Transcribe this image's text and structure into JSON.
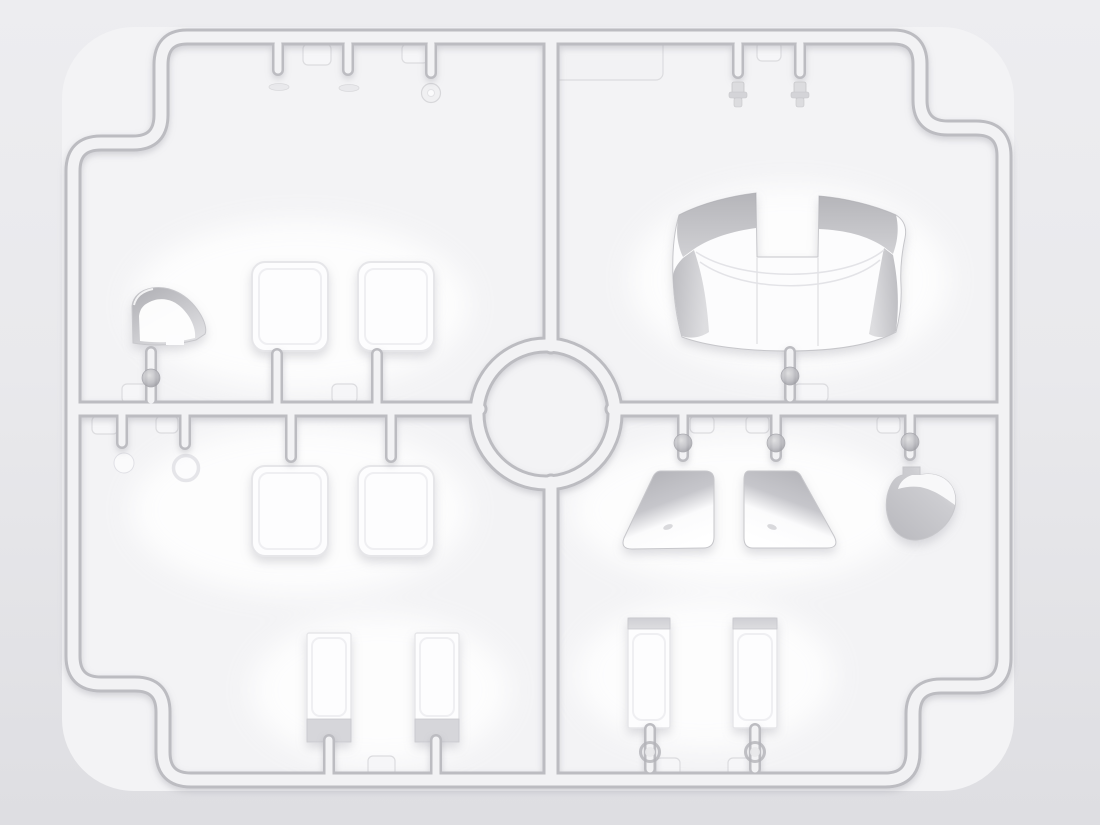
{
  "scene": {
    "title": "Injection-molded clear parts sprue for a scale model kit, top view render",
    "kind": "model-kit-sprue-render",
    "frame": {
      "shape": "rounded rectangle with stepped corners",
      "hub": "center ring connecting horizontal and vertical runners",
      "quadrants": 4
    },
    "parts": [
      {
        "id": "windscreen-small",
        "label": "Small curved windscreen",
        "quadrant": "top-left"
      },
      {
        "id": "side-window-a1",
        "label": "Side window glazing pane 1",
        "quadrant": "top-left"
      },
      {
        "id": "side-window-a2",
        "label": "Side window glazing pane 2",
        "quadrant": "top-left"
      },
      {
        "id": "lens-sliver-1",
        "label": "Small lens sliver",
        "quadrant": "top-left"
      },
      {
        "id": "lens-sliver-2",
        "label": "Small lens sliver",
        "quadrant": "top-left"
      },
      {
        "id": "lens-ring",
        "label": "Round light lens",
        "quadrant": "top-left"
      },
      {
        "id": "label-plate",
        "label": "Blank sprue label plate",
        "quadrant": "top-right"
      },
      {
        "id": "bulb-1",
        "label": "Small lamp lens",
        "quadrant": "top-right"
      },
      {
        "id": "bulb-2",
        "label": "Small lamp lens",
        "quadrant": "top-right"
      },
      {
        "id": "windshield-canopy",
        "label": "Wrap-around windshield",
        "quadrant": "top-right"
      },
      {
        "id": "ghost-lens-1",
        "label": "Faint round lens",
        "quadrant": "bottom-left"
      },
      {
        "id": "ghost-lens-2",
        "label": "Faint lens ring",
        "quadrant": "bottom-left"
      },
      {
        "id": "side-window-b1",
        "label": "Side window glazing pane 3",
        "quadrant": "bottom-left"
      },
      {
        "id": "side-window-b2",
        "label": "Side window glazing pane 4",
        "quadrant": "bottom-left"
      },
      {
        "id": "glazing-strip-l1",
        "label": "Glazing strip",
        "quadrant": "bottom-left"
      },
      {
        "id": "glazing-strip-l2",
        "label": "Glazing strip",
        "quadrant": "bottom-left"
      },
      {
        "id": "quarter-window-left",
        "label": "Quarter window, left",
        "quadrant": "bottom-right"
      },
      {
        "id": "quarter-window-right",
        "label": "Quarter window, right",
        "quadrant": "bottom-right"
      },
      {
        "id": "curved-quarter-light",
        "label": "Curved quarter light",
        "quadrant": "bottom-right"
      },
      {
        "id": "glazing-strip-r1",
        "label": "Glazing strip",
        "quadrant": "bottom-right"
      },
      {
        "id": "glazing-strip-r2",
        "label": "Glazing strip",
        "quadrant": "bottom-right"
      }
    ],
    "palette": {
      "bg_top": "#ededf0",
      "bg_mid": "#e9e9ec",
      "bg_bottom": "#dedee2",
      "interior_fill": "#f3f3f5",
      "rail_edge": "#bcbcc1",
      "rail_fill": "#f2f2f4",
      "tab_fill": "#f6f6f8",
      "tab_edge": "#dcdcdf",
      "plate_fill": "#f2f2f4",
      "part_white": "#fdfdfe",
      "part_edge": "#c7c7cb",
      "part_edge_soft": "#e6e6e9",
      "part_shade": "#b2b2b7",
      "band_gray": "#d6d6da",
      "ball_gray": "#aaaaaf",
      "shadow": "#9898a2"
    }
  }
}
